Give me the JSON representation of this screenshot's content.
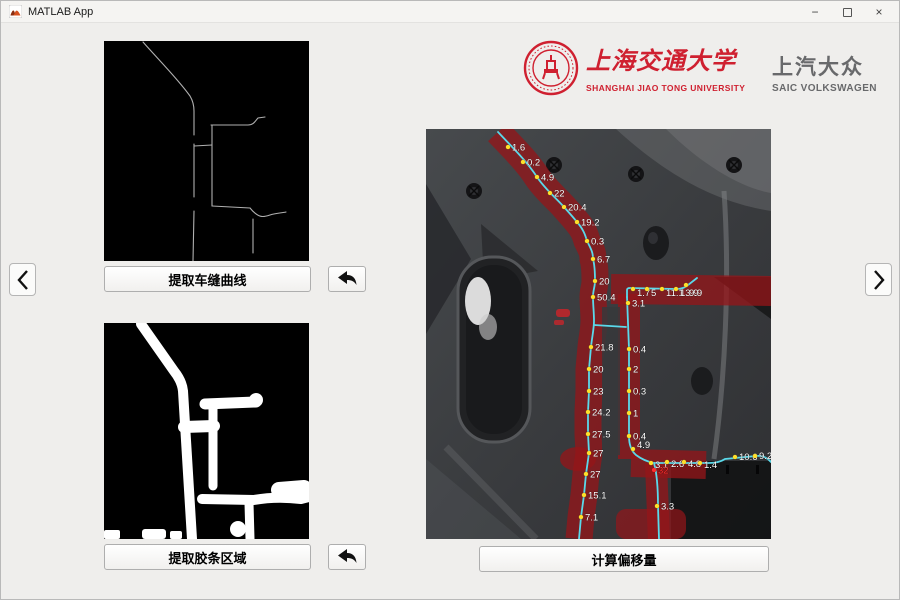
{
  "window": {
    "title": "MATLAB App"
  },
  "icons": {
    "app": "matlab-membrane",
    "minimize": "−",
    "maximize": "square-outline",
    "close": "×",
    "undo": "curved-left-arrow",
    "prev": "chevron-left",
    "next": "chevron-right"
  },
  "header": {
    "sjtu": {
      "name_cn": "上海交通大学",
      "name_en": "SHANGHAI JIAO TONG UNIVERSITY"
    },
    "saic": {
      "name_cn": "上汽大众",
      "name_en": "SAIC VOLKSWAGEN"
    }
  },
  "buttons": {
    "extract_seam_label": "提取车缝曲线",
    "extract_strip_label": "提取胶条区域",
    "compute_offset_label": "计算偏移量"
  },
  "colors": {
    "logo_red": "#cf2030",
    "logo_gray": "#68696b",
    "overlay_red": "#941519",
    "curve_cyan": "#5ad9ea",
    "dot_yellow": "#ffdf2b",
    "alert_red": "#ff2d2d"
  },
  "measurements": {
    "main_curve": [
      "1.6",
      "0.2",
      "4.9",
      "22",
      "20.4",
      "19.2",
      "0.3",
      "6.7",
      "20",
      "50.4",
      "21.8",
      "20",
      "23",
      "24.2",
      "27.5",
      "27",
      "27",
      "15.1",
      "7.1"
    ],
    "top_branch": [
      "1.7",
      "5",
      "11.1",
      "13.9",
      "9.9"
    ],
    "right_vertical": [
      "3.1",
      "0.4",
      "2",
      "0.3",
      "1",
      "0.4",
      "4.9"
    ],
    "bottom_branch": [
      "3.1",
      "2.6",
      "4.8",
      "1.4",
      "10.6",
      "9.2"
    ],
    "drop_branch": [
      "32",
      "3.3"
    ]
  },
  "image_annotations": [
    {
      "x": 82,
      "y": 18,
      "v": "1.6"
    },
    {
      "x": 97,
      "y": 33,
      "v": "0.2"
    },
    {
      "x": 111,
      "y": 48,
      "v": "4.9"
    },
    {
      "x": 124,
      "y": 64,
      "v": "22"
    },
    {
      "x": 138,
      "y": 78,
      "v": "20.4"
    },
    {
      "x": 151,
      "y": 93,
      "v": "19.2"
    },
    {
      "x": 161,
      "y": 112,
      "v": "0.3"
    },
    {
      "x": 167,
      "y": 130,
      "v": "6.7"
    },
    {
      "x": 169,
      "y": 152,
      "v": "20"
    },
    {
      "x": 167,
      "y": 168,
      "v": "50.4"
    },
    {
      "x": 165,
      "y": 218,
      "v": "21.8"
    },
    {
      "x": 163,
      "y": 240,
      "v": "20"
    },
    {
      "x": 163,
      "y": 262,
      "v": "23"
    },
    {
      "x": 162,
      "y": 283,
      "v": "24.2"
    },
    {
      "x": 162,
      "y": 305,
      "v": "27.5"
    },
    {
      "x": 163,
      "y": 324,
      "v": "27"
    },
    {
      "x": 160,
      "y": 345,
      "v": "27"
    },
    {
      "x": 158,
      "y": 366,
      "v": "15.1"
    },
    {
      "x": 155,
      "y": 388,
      "v": "7.1"
    },
    {
      "x": 207,
      "y": 160,
      "v": "1.7",
      "dy": 7
    },
    {
      "x": 221,
      "y": 160,
      "v": "5",
      "dy": 7
    },
    {
      "x": 236,
      "y": 160,
      "v": "11.1",
      "dy": 7
    },
    {
      "x": 250,
      "y": 160,
      "v": "13.9",
      "dy": 7
    },
    {
      "x": 260,
      "y": 156,
      "v": "9.9",
      "dx": 3,
      "dy": 11
    },
    {
      "x": 202,
      "y": 174,
      "v": "3.1"
    },
    {
      "x": 203,
      "y": 220,
      "v": "0.4"
    },
    {
      "x": 203,
      "y": 240,
      "v": "2"
    },
    {
      "x": 203,
      "y": 262,
      "v": "0.3"
    },
    {
      "x": 203,
      "y": 284,
      "v": "1"
    },
    {
      "x": 203,
      "y": 307,
      "v": "0.4"
    },
    {
      "x": 207,
      "y": 320,
      "v": "4.9",
      "dx": 4,
      "dy": -1
    },
    {
      "x": 225,
      "y": 334,
      "v": "3.1",
      "dy": 5
    },
    {
      "x": 241,
      "y": 333,
      "v": "2.6",
      "dy": 5
    },
    {
      "x": 258,
      "y": 333,
      "v": "4.8",
      "dy": 5
    },
    {
      "x": 274,
      "y": 334,
      "v": "1.4",
      "dy": 5
    },
    {
      "x": 309,
      "y": 328,
      "v": "10.6",
      "dy": 3
    },
    {
      "x": 329,
      "y": 327,
      "v": "9.2",
      "dy": 3
    },
    {
      "x": 228,
      "y": 341,
      "v": "32",
      "c": "r"
    },
    {
      "x": 231,
      "y": 377,
      "v": "3.3"
    }
  ]
}
